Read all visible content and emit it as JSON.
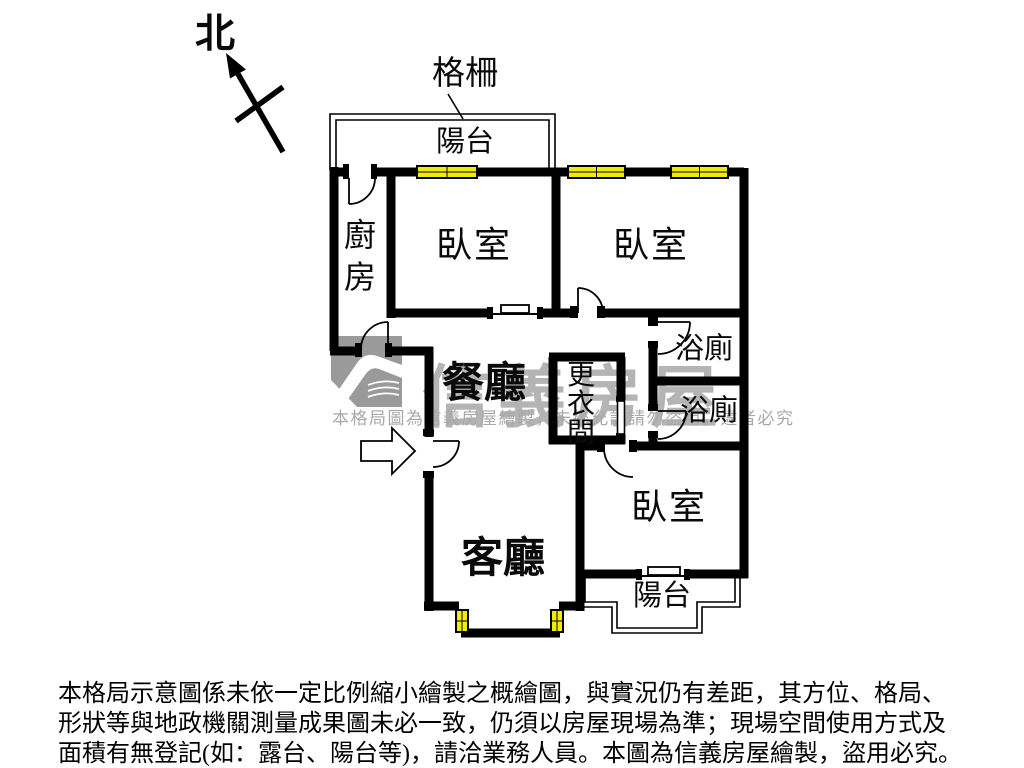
{
  "compass": {
    "label": "北"
  },
  "annotations": {
    "grille": "格柵"
  },
  "rooms": {
    "balcony_top": "陽台",
    "kitchen": "廚房",
    "bedroom_top_left": "臥室",
    "bedroom_top_right": "臥室",
    "dining": "餐廳",
    "closet": "更衣間",
    "bath_upper": "浴廁",
    "bath_lower": "浴廁",
    "living": "客廳",
    "bedroom_bottom": "臥室",
    "balcony_bottom": "陽台"
  },
  "watermark": {
    "brand": "信義房屋",
    "notice": "本格局圖為信義房屋繪製，未經允許請勿盜用，違者必究"
  },
  "disclaimer": {
    "line1": "本格局示意圖係未依一定比例縮小繪製之概繪圖，與實況仍有差距，其方位、格局、",
    "line2": "形狀等與地政機關測量成果圖未必一致，仍須以房屋現場為準；現場空間使用方式及",
    "line3": "面積有無登記(如：露台、陽台等)，請洽業務人員。本圖為信義房屋繪製，盜用必究。"
  },
  "colors": {
    "wall": "#000000",
    "window": "#f1ed00",
    "watermark_gray": "#b4b4b4",
    "background": "#ffffff"
  }
}
